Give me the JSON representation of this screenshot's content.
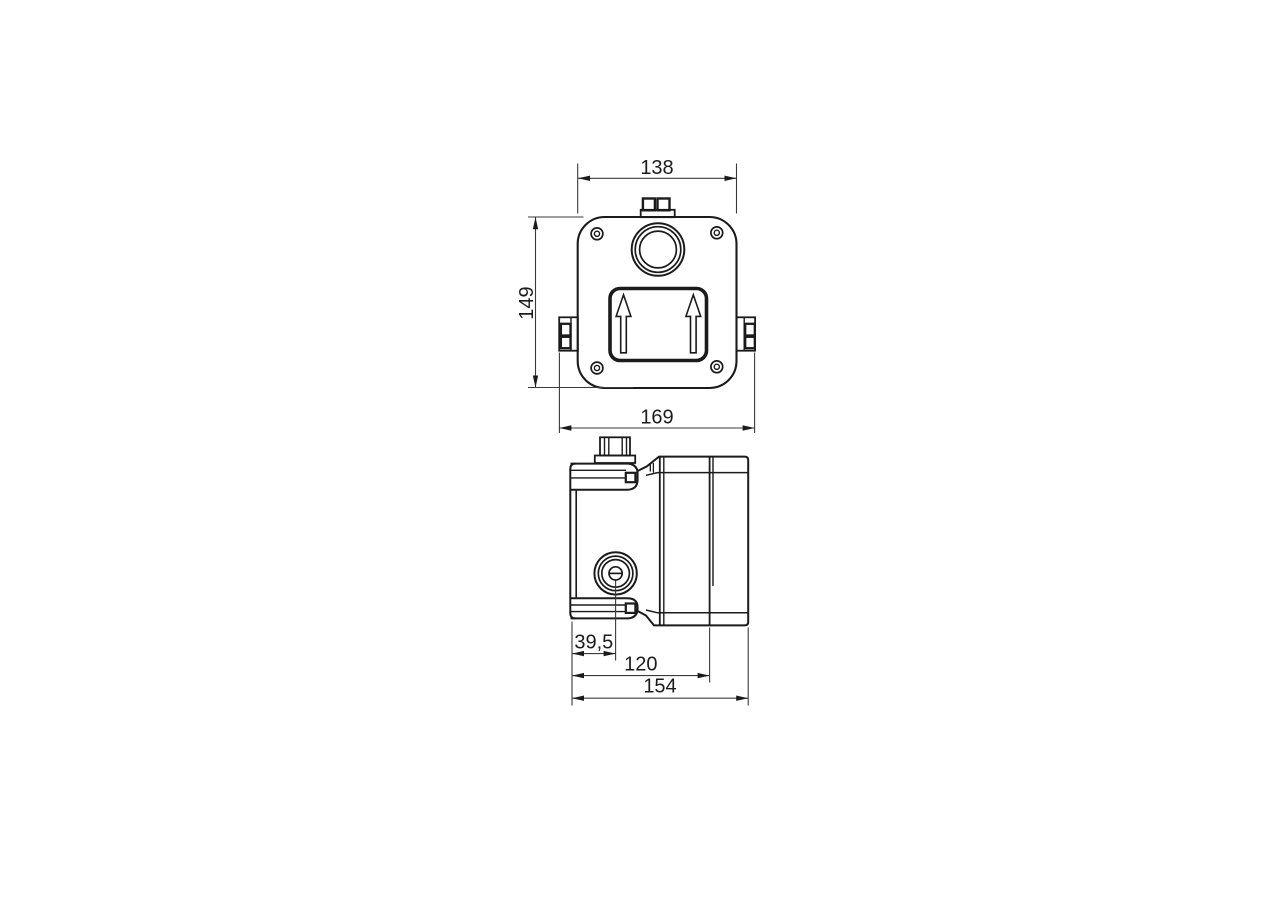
{
  "page": {
    "background": "#ffffff"
  },
  "drawing": {
    "line_color": "#1b1b1b",
    "front_view": {
      "dim_top_width": "138",
      "dim_height": "149",
      "dim_overall_width": "169"
    },
    "side_view": {
      "dim_knob_offset": "39,5",
      "dim_body_depth": "120",
      "dim_overall_depth": "154"
    }
  }
}
